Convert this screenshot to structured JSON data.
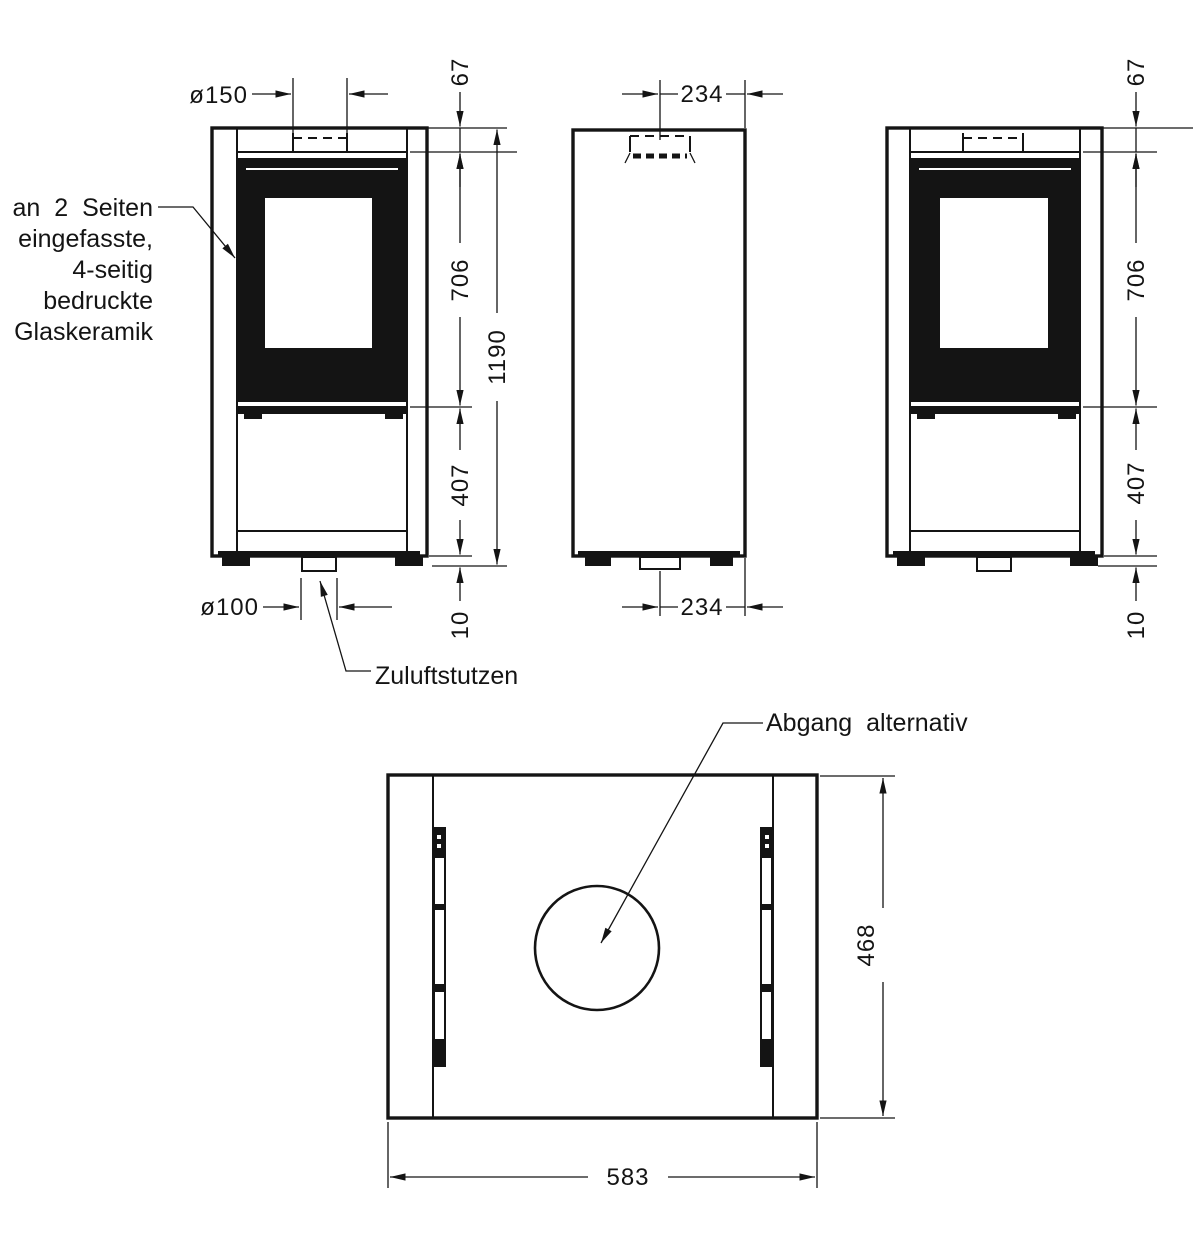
{
  "dims": {
    "flue_diameter": "ø150",
    "inlet_diameter": "ø100",
    "top_offset": "67",
    "glass_height": "706",
    "total_height": "1190",
    "lower_height": "407",
    "base_gap": "10",
    "flue_rear_distance": "234",
    "depth": "468",
    "width": "583"
  },
  "labels": {
    "glass_note": [
      "an 2 Seiten",
      "eingefasste,",
      "4-seitig",
      "bedruckte",
      "Glaskeramik"
    ],
    "inlet": "Zuluftstutzen",
    "outlet": "Abgang alternativ"
  }
}
